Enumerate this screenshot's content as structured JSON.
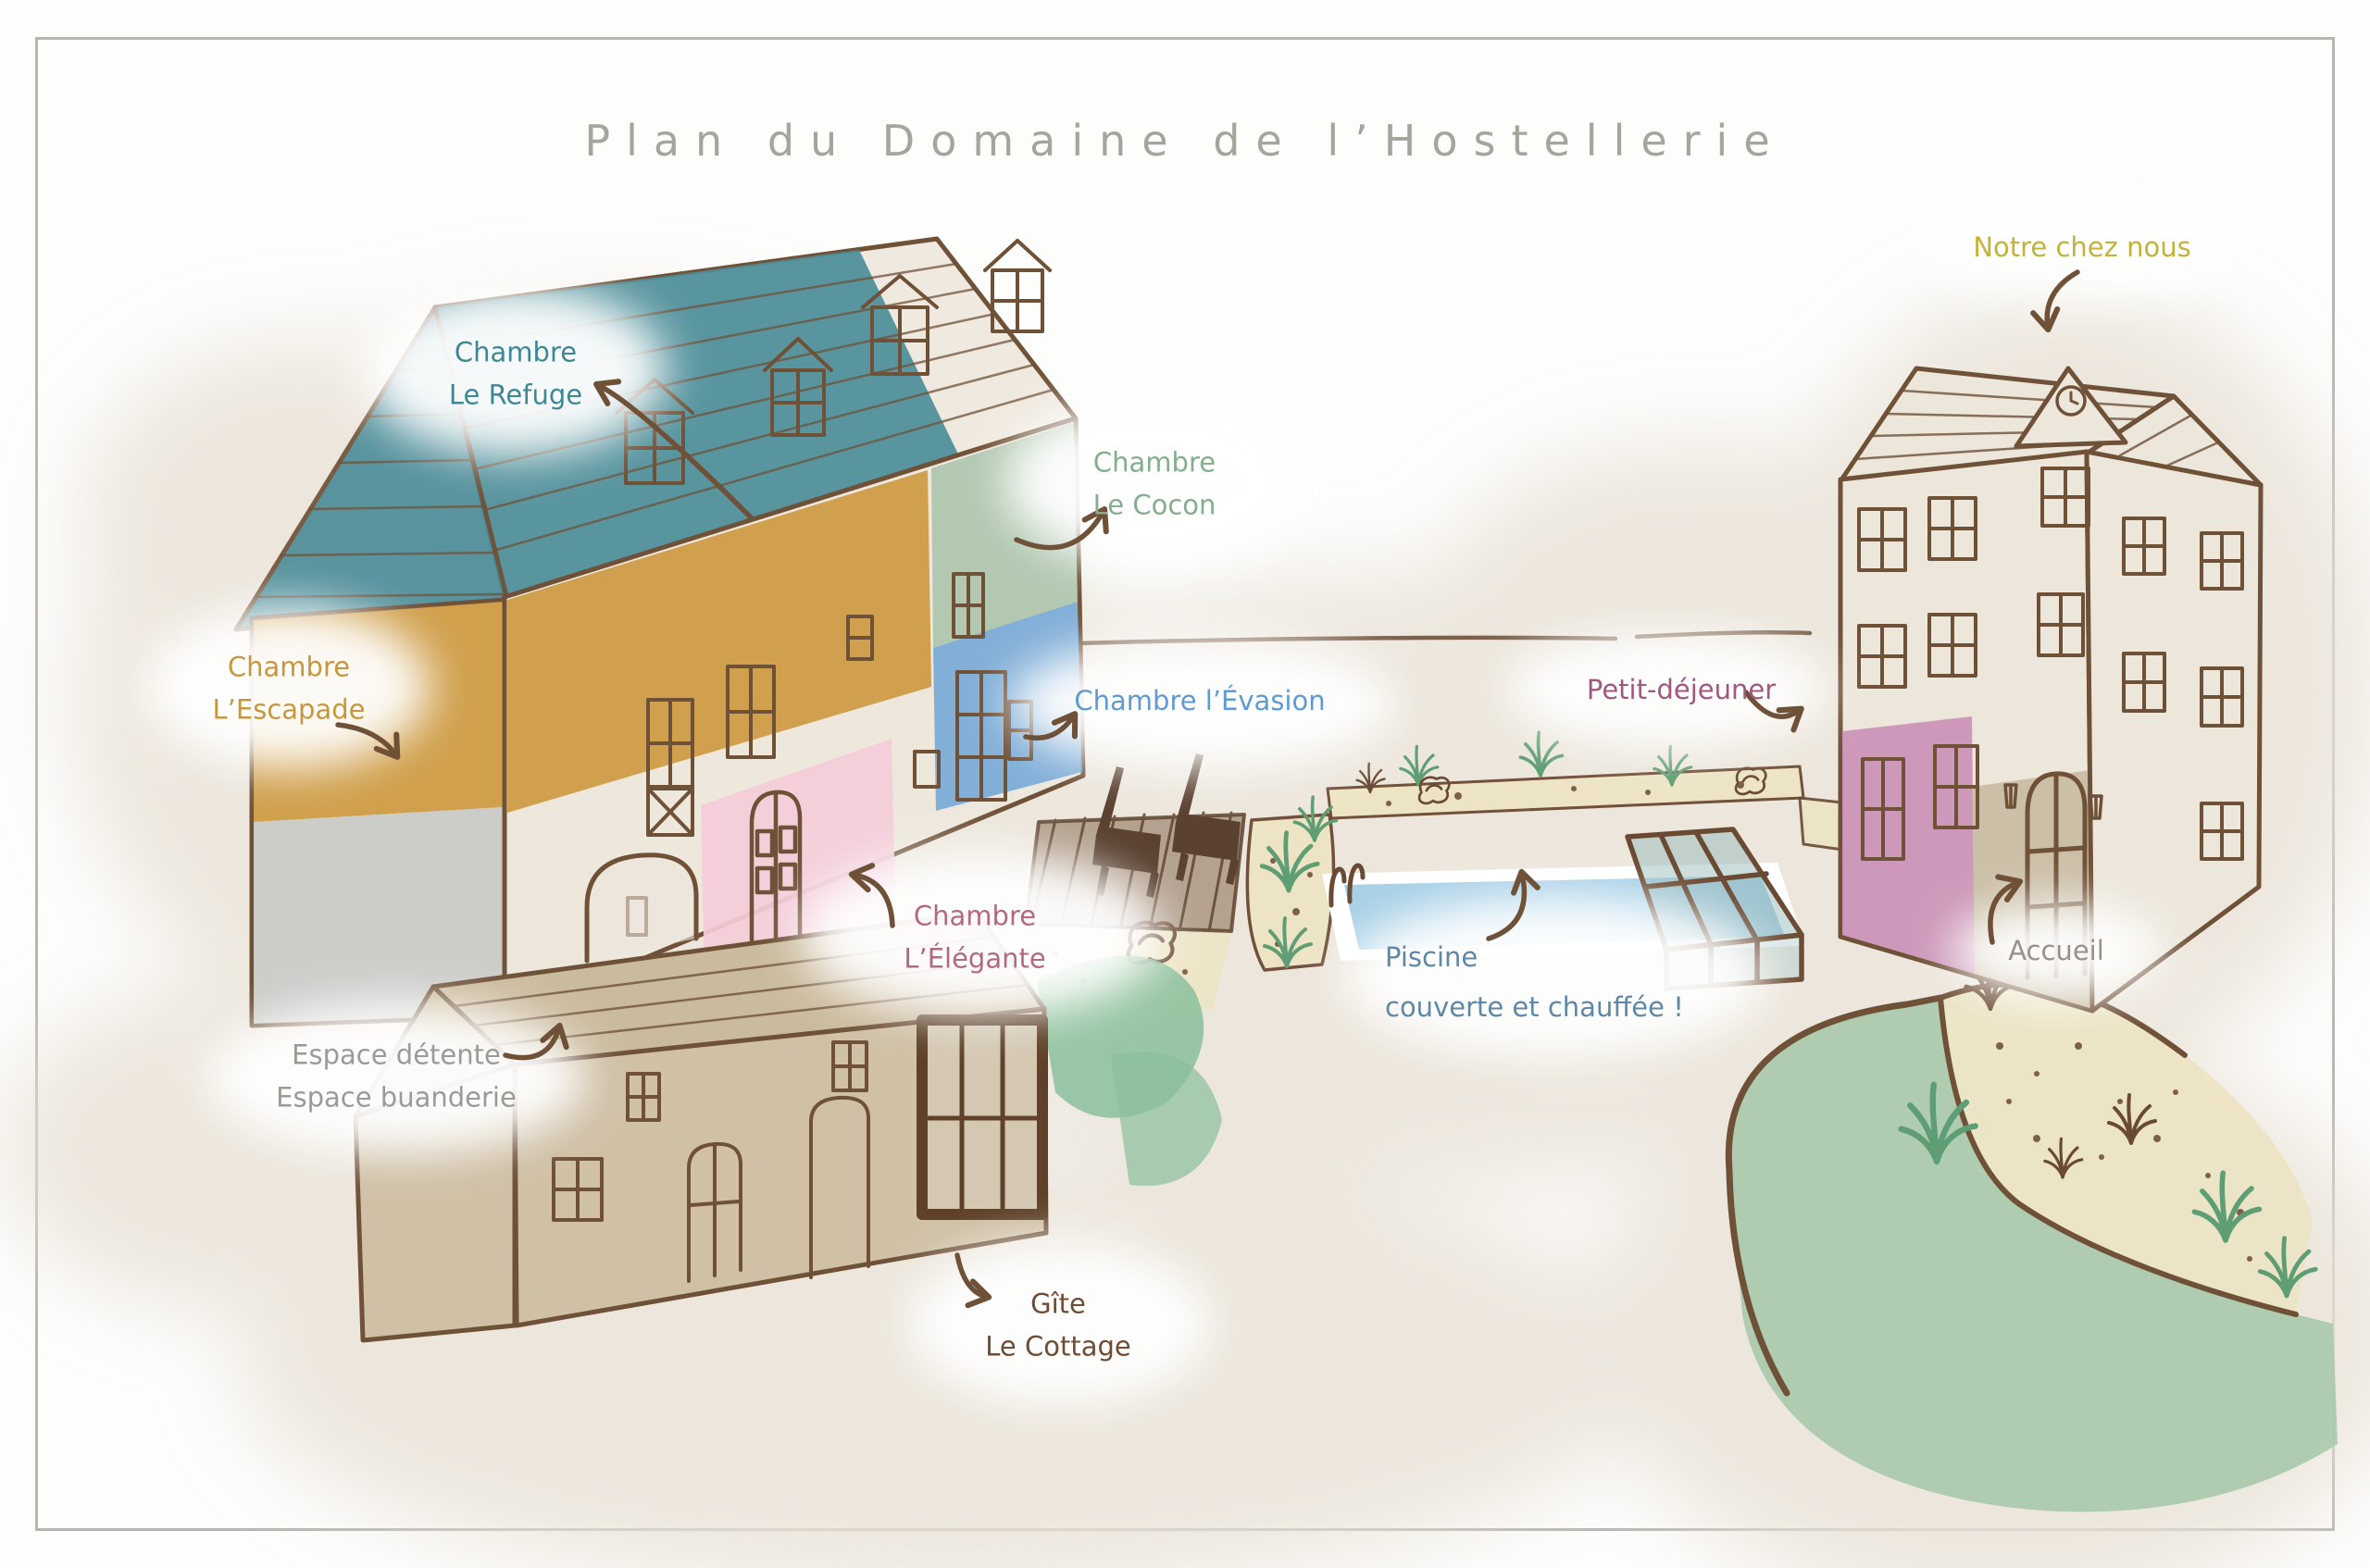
{
  "title": "Plan du Domaine de l’Hostellerie",
  "palette": {
    "title_gray": "#a7a49e",
    "outline_brown": "#6f5138",
    "wash_beige": "#e8e1d5",
    "teal_roof": "#4c8d99",
    "mustard_wall": "#cd9a41",
    "gray_wall": "#c9c9c7",
    "sage_wall": "#aac4ab",
    "blue_wall": "#6fa5d6",
    "pink_wall": "#f4cdd9",
    "manor_pink": "#ca8fb5",
    "manor_tan": "#c8baa2",
    "cottage_tan": "#cfc0a6",
    "pool_blue": "#a7cfe6",
    "lawn_green": "#a9c9ab",
    "sand": "#ece4c4"
  },
  "labels": {
    "refuge": {
      "text": "Chambre\nLe Refuge",
      "color": "#3f8795"
    },
    "cocon": {
      "text": "Chambre\nLe Cocon",
      "color": "#84ae8c"
    },
    "escapade": {
      "text": "Chambre\nL’Escapade",
      "color": "#c7973f"
    },
    "evasion": {
      "text": "Chambre l’Évasion",
      "color": "#5f9ad3"
    },
    "elegante": {
      "text": "Chambre\nL’Élégante",
      "color": "#b26b7e"
    },
    "espace": {
      "text": "Espace détente\nEspace buanderie",
      "color": "#9b9a96"
    },
    "gite": {
      "text": "Gîte\nLe Cottage",
      "color": "#6f4c33"
    },
    "piscine": {
      "text": "Piscine\ncouverte et chauffée !",
      "color": "#5e88a6"
    },
    "petit_dejeuner": {
      "text": "Petit-déjeuner",
      "color": "#a2577f"
    },
    "notre_chez_nous": {
      "text": "Notre chez nous",
      "color": "#c3b33c"
    },
    "accueil": {
      "text": "Accueil",
      "color": "#9a9087"
    }
  }
}
